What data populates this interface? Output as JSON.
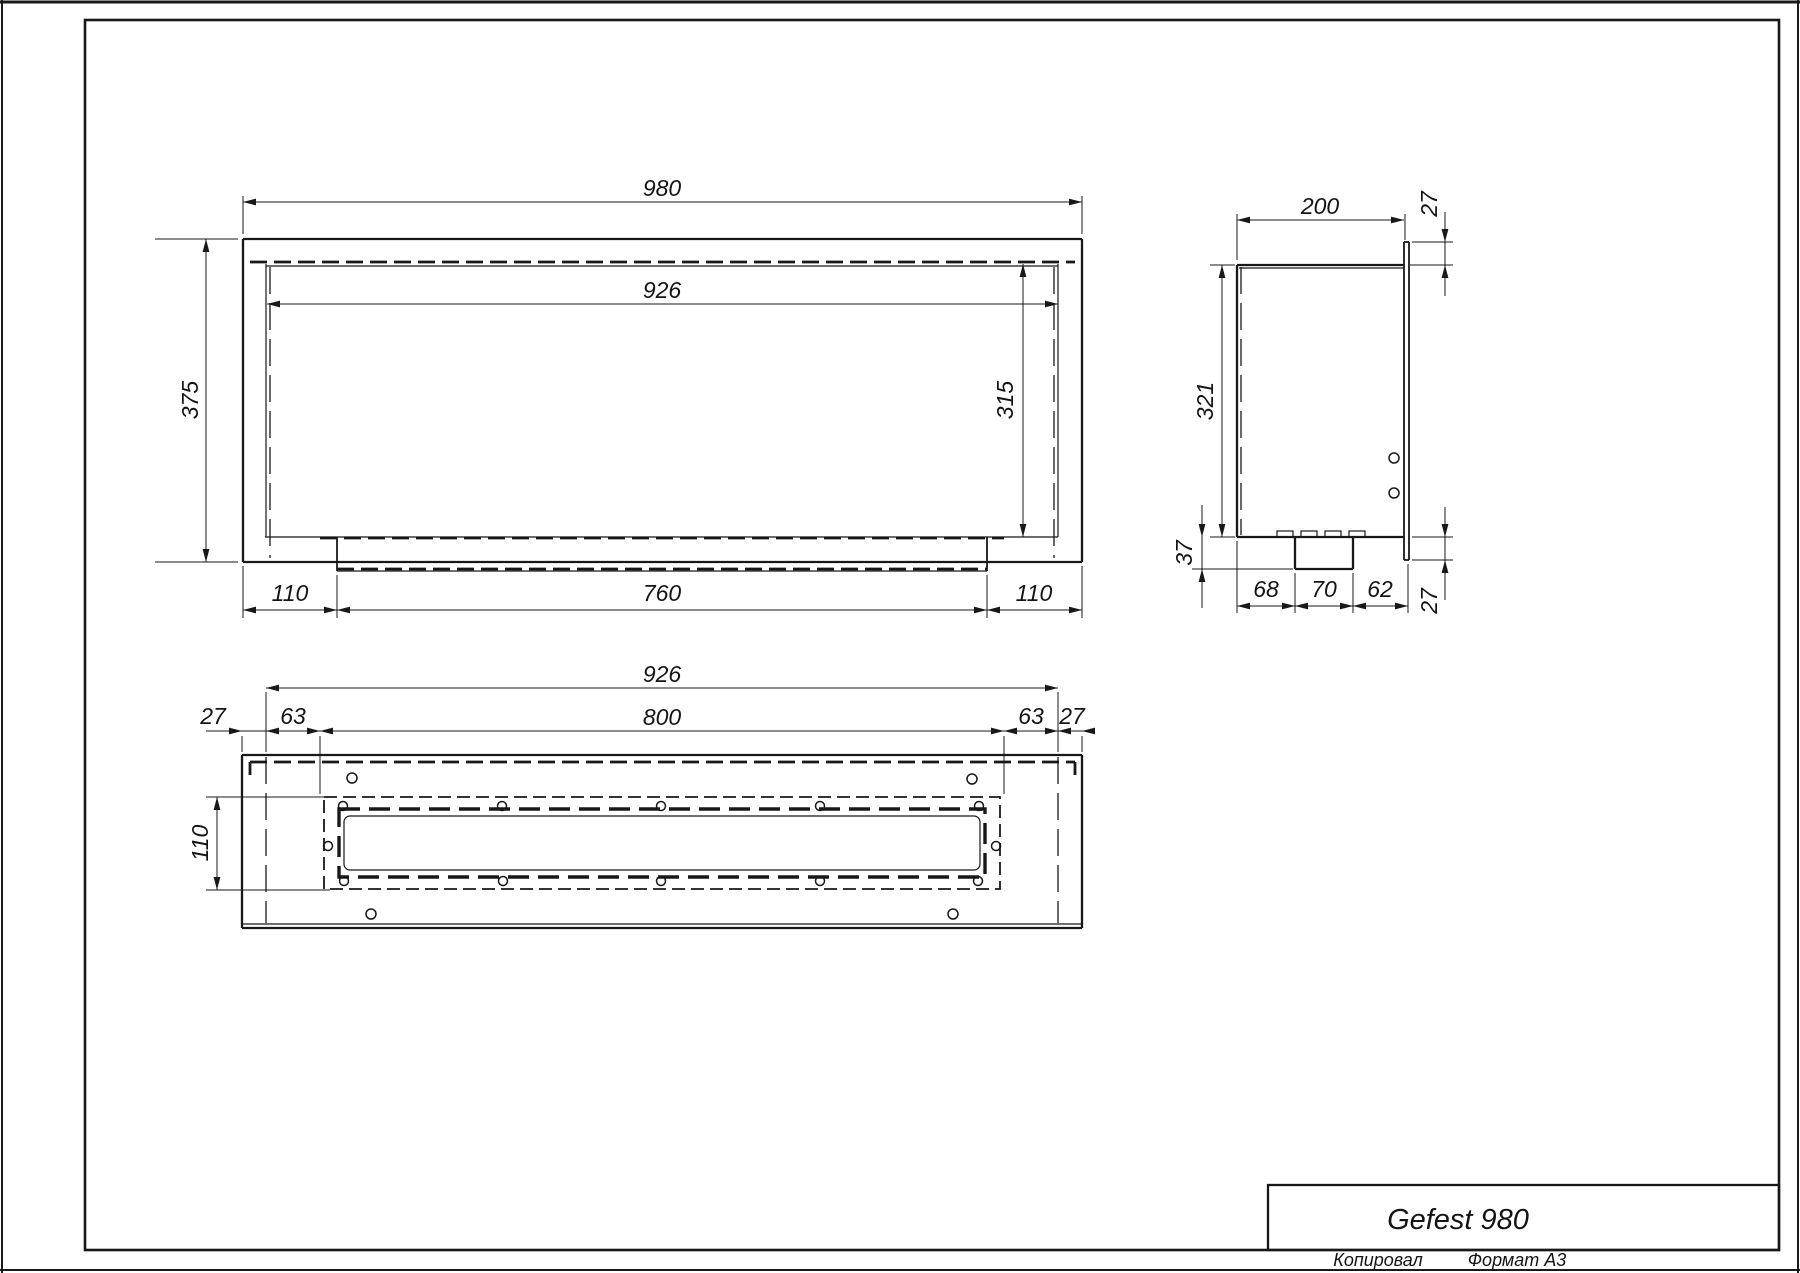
{
  "drawing": {
    "front_view": {
      "overall_width": "980",
      "opening_width": "926",
      "overall_height": "375",
      "opening_height": "315",
      "bottom_chain": [
        "110",
        "760",
        "110"
      ]
    },
    "side_view": {
      "depth": "200",
      "top_flange": "27",
      "opening_height": "321",
      "burner_depth": "37",
      "bottom_chain": [
        "68",
        "70",
        "62"
      ],
      "bottom_flange": "27"
    },
    "bottom_view": {
      "opening_width": "926",
      "burner_cutout_length": "800",
      "left_chain": [
        "27",
        "63"
      ],
      "right_chain": [
        "63",
        "27"
      ],
      "burner_cutout_width": "110"
    },
    "title_block": {
      "model": "Gefest 980",
      "copied_label": "Копировал",
      "format_label": "Формат A3"
    }
  }
}
